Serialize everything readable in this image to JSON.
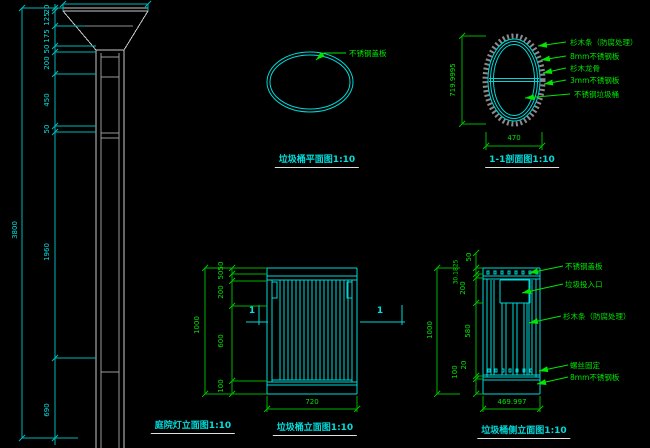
{
  "drawing": {
    "background": "#000000",
    "colors": {
      "cad_line_cyan": "#00e0e0",
      "dim_green": "#00e600",
      "lamp_line_white": "#c8c8c8",
      "hatch_gray": "#8a8a8a",
      "title_underline_white": "#e0e0e0"
    },
    "views": {
      "lamp": {
        "title": "庭院灯立面图1:10",
        "dims": {
          "overall": "3800",
          "chain": [
            "20",
            "125",
            "175",
            "50",
            "200",
            "450",
            "50",
            "1960",
            "690"
          ]
        }
      },
      "plan": {
        "title": "垃圾桶平面图1:10",
        "label": "不锈钢盖板"
      },
      "section": {
        "title": "1-1剖面图1:10",
        "dims": {
          "height": "719.9995",
          "width": "470"
        },
        "labels": [
          "杉木条（防腐处理）",
          "8mm不锈钢板",
          "杉木龙骨",
          "3mm不锈钢板",
          "不锈钢垃圾桶"
        ]
      },
      "front": {
        "title": "垃圾桶立面图1:10",
        "marker": "1",
        "dims": {
          "overall": "1000",
          "chain": [
            "50",
            "50",
            "200",
            "600",
            "100"
          ],
          "width": "720"
        }
      },
      "side": {
        "title": "垃圾桶侧立面图1:10",
        "dims": {
          "overall": "1000",
          "chain": [
            "50",
            "30.1825",
            "200",
            "580",
            "20",
            "100"
          ],
          "width": "469.997"
        },
        "labels": [
          "不锈钢盖板",
          "垃圾投入口",
          "杉木条（防腐处理）",
          "螺丝固定",
          "8mm不锈钢板"
        ]
      }
    }
  }
}
